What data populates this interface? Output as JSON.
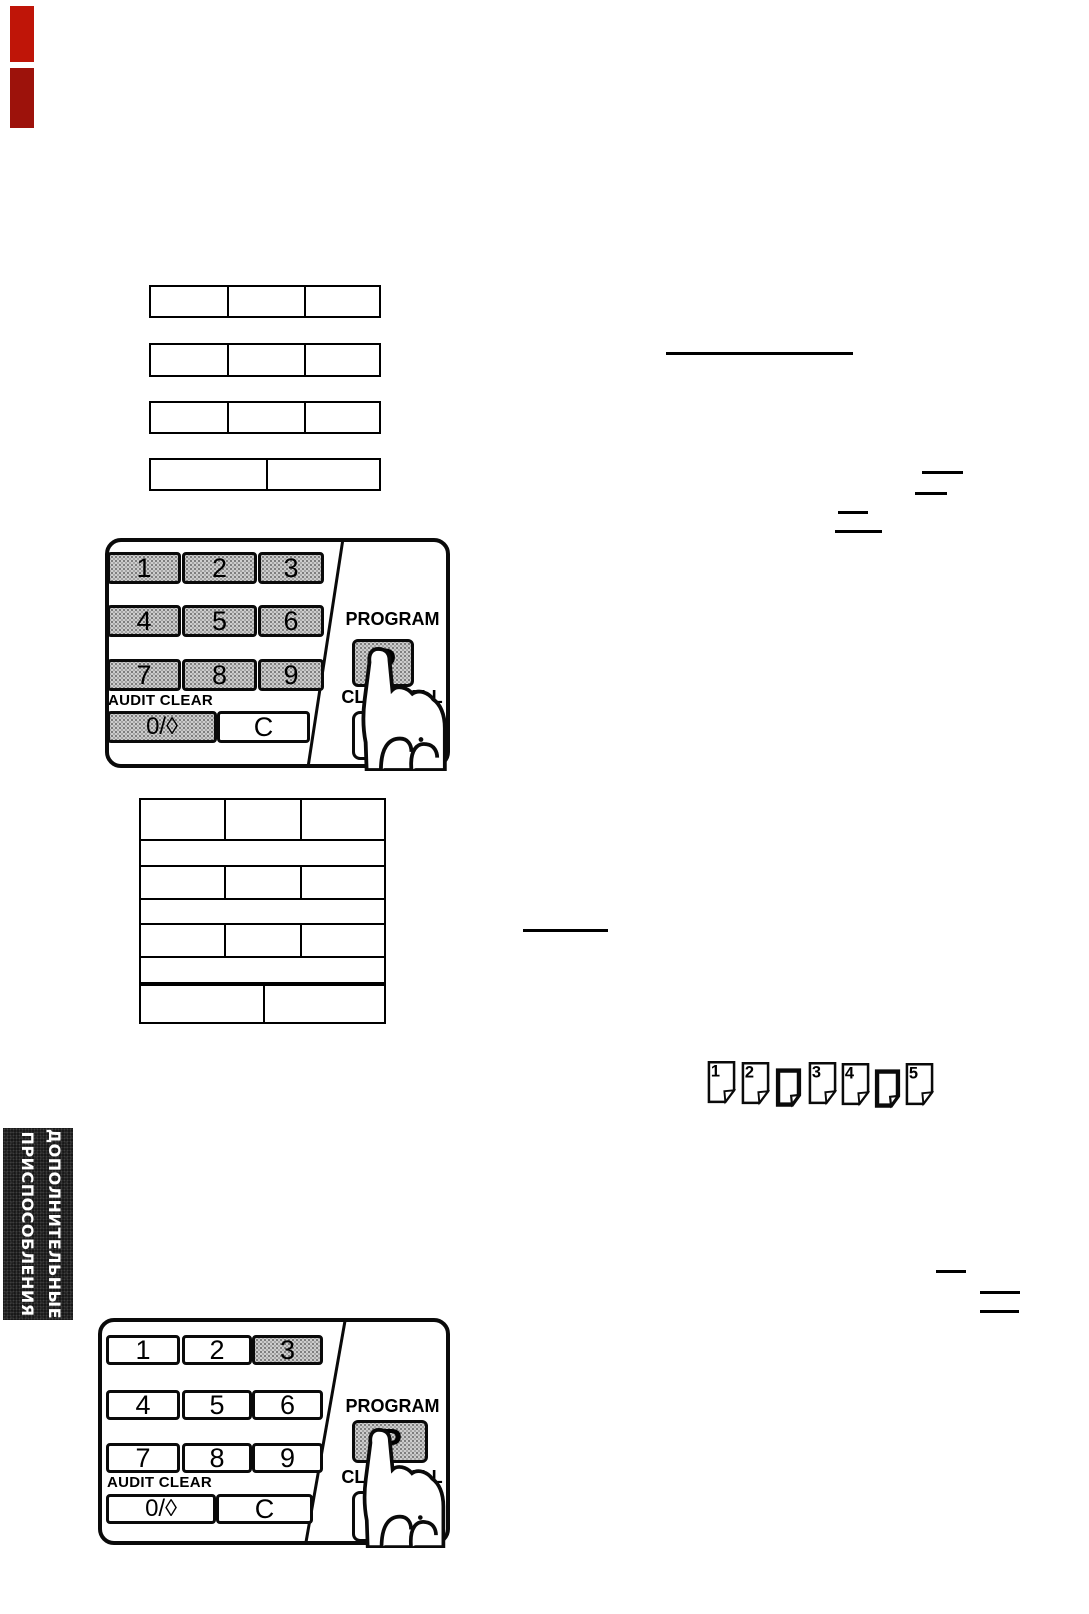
{
  "sidebar_tab": {
    "line1": "ДОПОЛНИТЕЛЬНЫЕ",
    "line2": "ПРИСПОСОБЛЕНИЯ"
  },
  "keypads": [
    {
      "keys": [
        "1",
        "2",
        "3",
        "4",
        "5",
        "6",
        "7",
        "8",
        "9"
      ],
      "audit_clear": "AUDIT CLEAR",
      "zero_key": "0/◊",
      "clear_key": "C",
      "program": "PROGRAM",
      "p_key": "P",
      "clear_all": "CLEAR ALL",
      "shaded_keys": "1 2 3 4 5 6 7 8 9 0/◊ P"
    },
    {
      "keys": [
        "1",
        "2",
        "3",
        "4",
        "5",
        "6",
        "7",
        "8",
        "9"
      ],
      "audit_clear": "AUDIT CLEAR",
      "zero_key": "0/◊",
      "clear_key": "C",
      "program": "PROGRAM",
      "p_key": "P",
      "clear_all": "CLEAR ALL",
      "shaded_keys": "3 P"
    }
  ],
  "page_icons": [
    {
      "label": "1",
      "thick": false
    },
    {
      "label": "2",
      "thick": false
    },
    {
      "label": "",
      "thick": true
    },
    {
      "label": "3",
      "thick": false
    },
    {
      "label": "4",
      "thick": false
    },
    {
      "label": "",
      "thick": true
    },
    {
      "label": "5",
      "thick": false
    }
  ],
  "colors": {
    "red_mark_top": "#bf1508",
    "red_mark_bottom": "#9d120b",
    "key_shade": "#bdbdbd",
    "tab_bg": "#101010",
    "ink": "#000000"
  }
}
